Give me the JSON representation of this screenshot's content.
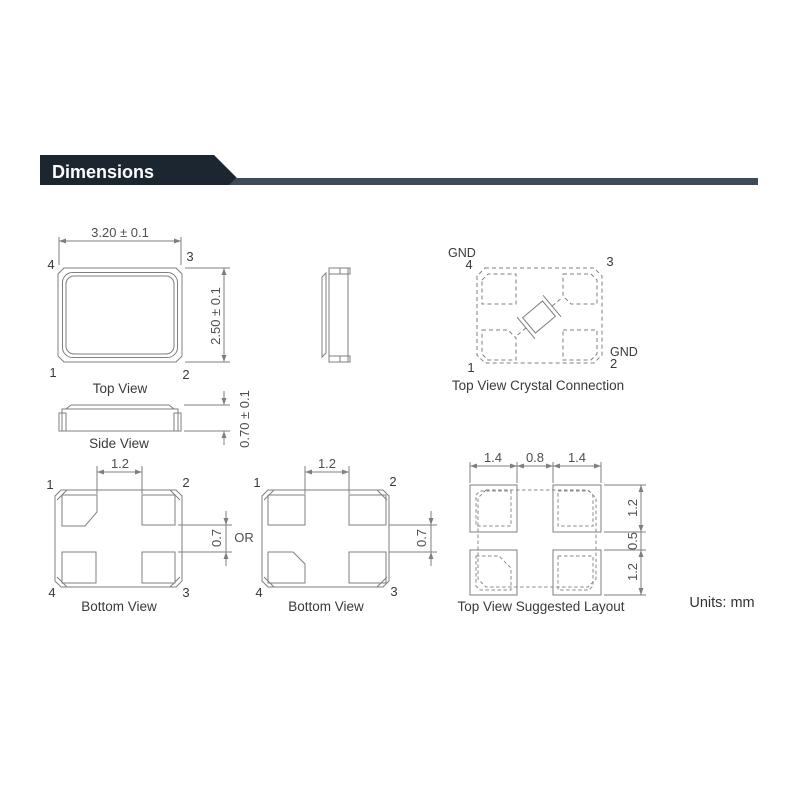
{
  "header": {
    "title": "Dimensions"
  },
  "units_label": "Units: mm",
  "top_view": {
    "caption": "Top View",
    "dim_width": "3.20 ± 0.1",
    "dim_height": "2.50 ± 0.1",
    "pin_tl": "4",
    "pin_tr": "3",
    "pin_bl": "1",
    "pin_br": "2"
  },
  "side_view": {
    "caption": "Side View",
    "dim_height": "0.70 ± 0.1"
  },
  "crystal_connection": {
    "caption": "Top View Crystal Connection",
    "gnd_top": "GND",
    "gnd_right": "GND",
    "pin_tl": "4",
    "pin_tr": "3",
    "pin_bl": "1",
    "pin_br": "2"
  },
  "bottom_view_a": {
    "caption": "Bottom View",
    "dim_top": "1.2",
    "dim_right": "0.7",
    "pin_tl": "1",
    "pin_tr": "2",
    "pin_bl": "4",
    "pin_br": "3"
  },
  "or_label": "OR",
  "bottom_view_b": {
    "caption": "Bottom View",
    "dim_top": "1.2",
    "dim_right": "0.7",
    "pin_tl": "1",
    "pin_tr": "2",
    "pin_bl": "4",
    "pin_br": "3"
  },
  "suggested_layout": {
    "caption": "Top View Suggested Layout",
    "dim_top_left": "1.4",
    "dim_top_center": "0.8",
    "dim_top_right": "1.4",
    "dim_right_top": "1.2",
    "dim_right_center": "0.5",
    "dim_right_bottom": "1.2"
  },
  "colors": {
    "banner_dark": "#1c2631",
    "banner_bar": "#3d4b58",
    "line": "#7f7f7f",
    "text": "#3a3a3a"
  }
}
